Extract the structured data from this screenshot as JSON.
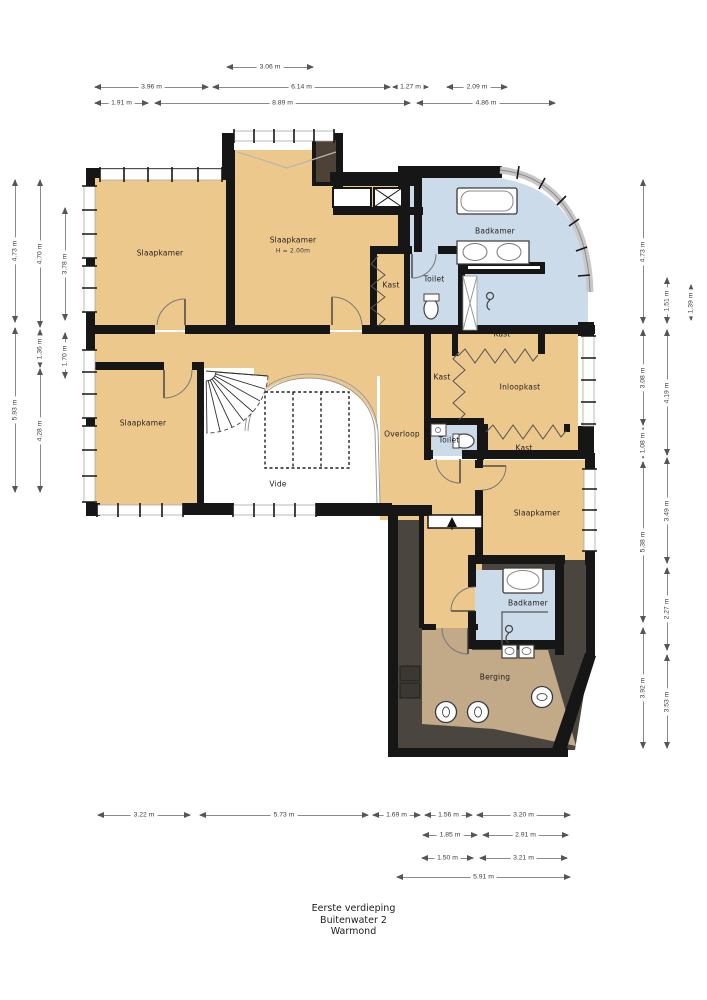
{
  "title_block": {
    "line1": "Eerste verdieping",
    "line2": "Buitenwater 2",
    "line3": "Warmond"
  },
  "colors": {
    "room_fill": "#edc88d",
    "bathroom_fill": "#cbdbe9",
    "storage_fill": "#c2a987",
    "attic_fill": "#4a463f",
    "wall": "#161616",
    "window_band": "#c8c8c8"
  },
  "rooms": [
    {
      "id": "slaapkamer-1",
      "label": "Slaapkamer",
      "x": 160,
      "y": 253
    },
    {
      "id": "slaapkamer-2",
      "label": "Slaapkamer",
      "x": 293,
      "y": 240
    },
    {
      "id": "slaapkamer-2-height",
      "label": "H = 2.00m",
      "x": 293,
      "y": 251,
      "small": true
    },
    {
      "id": "badkamer-1",
      "label": "Badkamer",
      "x": 495,
      "y": 231
    },
    {
      "id": "kast-1",
      "label": "Kast",
      "x": 391,
      "y": 285
    },
    {
      "id": "toilet-1",
      "label": "Toilet",
      "x": 434,
      "y": 279
    },
    {
      "id": "kast-2",
      "label": "Kast",
      "x": 502,
      "y": 334
    },
    {
      "id": "kast-3",
      "label": "Kast",
      "x": 442,
      "y": 377
    },
    {
      "id": "inloopkast",
      "label": "Inloopkast",
      "x": 520,
      "y": 387
    },
    {
      "id": "toilet-2",
      "label": "Toilet",
      "x": 449,
      "y": 440
    },
    {
      "id": "kast-4",
      "label": "Kast",
      "x": 524,
      "y": 448
    },
    {
      "id": "overloop",
      "label": "Overloop",
      "x": 402,
      "y": 434
    },
    {
      "id": "slaapkamer-3",
      "label": "Slaapkamer",
      "x": 143,
      "y": 423
    },
    {
      "id": "vide",
      "label": "Vide",
      "x": 278,
      "y": 484
    },
    {
      "id": "slaapkamer-4",
      "label": "Slaapkamer",
      "x": 537,
      "y": 513
    },
    {
      "id": "badkamer-2",
      "label": "Badkamer",
      "x": 528,
      "y": 603
    },
    {
      "id": "berging",
      "label": "Berging",
      "x": 495,
      "y": 677
    }
  ],
  "dimensions": {
    "horizontal": [
      {
        "label": "3.06 m",
        "x1": 227,
        "x2": 313,
        "y": 67
      },
      {
        "label": "3.96 m",
        "x1": 95,
        "x2": 208,
        "y": 87
      },
      {
        "label": "6.14 m",
        "x1": 213,
        "x2": 390,
        "y": 87
      },
      {
        "label": "1.27 m",
        "x1": 393,
        "x2": 428,
        "y": 87
      },
      {
        "label": "2.09 m",
        "x1": 447,
        "x2": 507,
        "y": 87
      },
      {
        "label": "1.91 m",
        "x1": 95,
        "x2": 148,
        "y": 103
      },
      {
        "label": "8.89 m",
        "x1": 155,
        "x2": 410,
        "y": 103
      },
      {
        "label": "4.86 m",
        "x1": 417,
        "x2": 555,
        "y": 103
      },
      {
        "label": "3.22 m",
        "x1": 98,
        "x2": 190,
        "y": 815
      },
      {
        "label": "5.73 m",
        "x1": 200,
        "x2": 368,
        "y": 815
      },
      {
        "label": "1.69 m",
        "x1": 373,
        "x2": 420,
        "y": 815
      },
      {
        "label": "1.56 m",
        "x1": 425,
        "x2": 472,
        "y": 815
      },
      {
        "label": "3.20 m",
        "x1": 477,
        "x2": 570,
        "y": 815
      },
      {
        "label": "1.85 m",
        "x1": 423,
        "x2": 477,
        "y": 835
      },
      {
        "label": "2.91 m",
        "x1": 483,
        "x2": 568,
        "y": 835
      },
      {
        "label": "1.50 m",
        "x1": 422,
        "x2": 473,
        "y": 858
      },
      {
        "label": "3.21 m",
        "x1": 480,
        "x2": 567,
        "y": 858
      },
      {
        "label": "5.91 m",
        "x1": 397,
        "x2": 570,
        "y": 877
      }
    ],
    "vertical": [
      {
        "label": "4.73 m",
        "x": 15,
        "y1": 180,
        "y2": 322
      },
      {
        "label": "5.93 m",
        "x": 15,
        "y1": 328,
        "y2": 492
      },
      {
        "label": "4.70 m",
        "x": 40,
        "y1": 180,
        "y2": 327
      },
      {
        "label": "1.36 m",
        "x": 40,
        "y1": 330,
        "y2": 367
      },
      {
        "label": "4.28 m",
        "x": 40,
        "y1": 369,
        "y2": 492
      },
      {
        "label": "3.78 m",
        "x": 65,
        "y1": 208,
        "y2": 320
      },
      {
        "label": "1.70 m",
        "x": 65,
        "y1": 333,
        "y2": 378
      },
      {
        "label": "4.73 m",
        "x": 643,
        "y1": 180,
        "y2": 323
      },
      {
        "label": "3.08 m",
        "x": 643,
        "y1": 330,
        "y2": 425
      },
      {
        "label": "1.08 m",
        "x": 643,
        "y1": 428,
        "y2": 458
      },
      {
        "label": "5.38 m",
        "x": 643,
        "y1": 462,
        "y2": 622
      },
      {
        "label": "3.92 m",
        "x": 643,
        "y1": 628,
        "y2": 748
      },
      {
        "label": "1.51 m",
        "x": 667,
        "y1": 278,
        "y2": 323
      },
      {
        "label": "4.19 m",
        "x": 667,
        "y1": 330,
        "y2": 455
      },
      {
        "label": "3.49 m",
        "x": 667,
        "y1": 458,
        "y2": 563
      },
      {
        "label": "2.27 m",
        "x": 667,
        "y1": 568,
        "y2": 650
      },
      {
        "label": "3.53 m",
        "x": 667,
        "y1": 655,
        "y2": 748
      },
      {
        "label": "1.39 m",
        "x": 691,
        "y1": 285,
        "y2": 320
      }
    ]
  }
}
